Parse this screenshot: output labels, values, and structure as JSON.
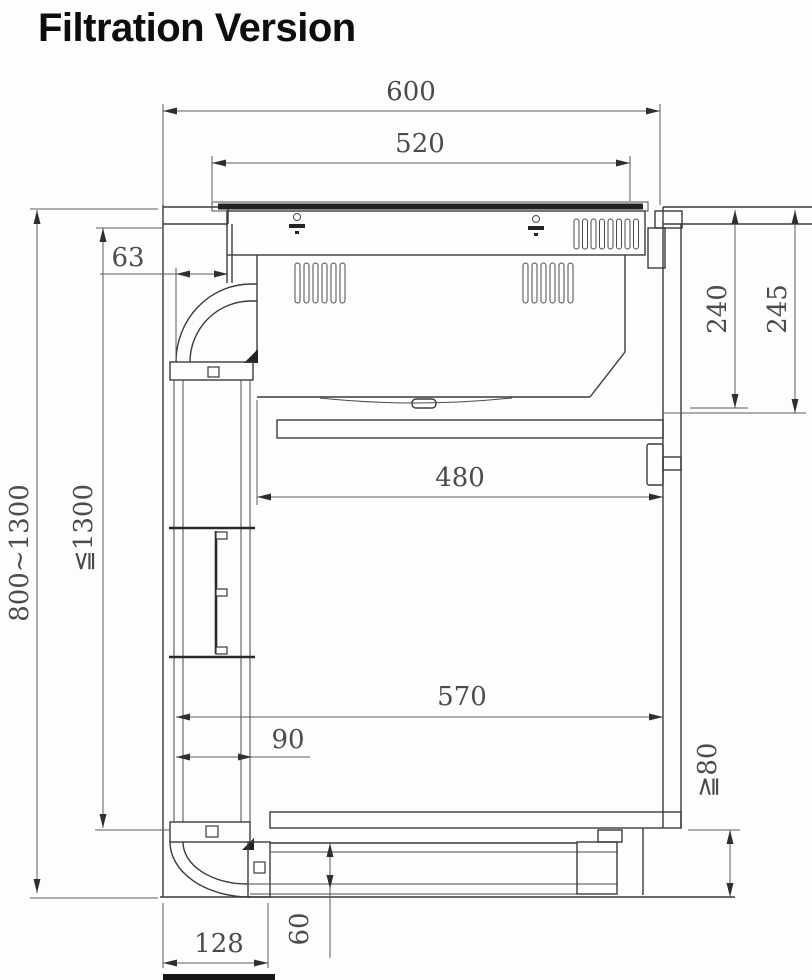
{
  "title": "Filtration Version",
  "drawing": {
    "type": "installation-cross-section",
    "subject": "downdraft hob recirculation (filtration) duct in kitchen cabinet",
    "units": "mm",
    "dims": {
      "worktop_cutout_width": "600",
      "hob_top_width": "520",
      "duct_front_offset": "63",
      "hob_body_depth": "240",
      "clearance_depth": "245",
      "worktop_height_range": "800~1300",
      "max_duct_drop": "≦1300",
      "inner_cabinet_width": "480",
      "lower_clearance_width": "570",
      "duct_section_width": "90",
      "plinth_clearance_min": "≧80",
      "floor_elbow_depth": "128",
      "floor_duct_height": "60"
    }
  }
}
